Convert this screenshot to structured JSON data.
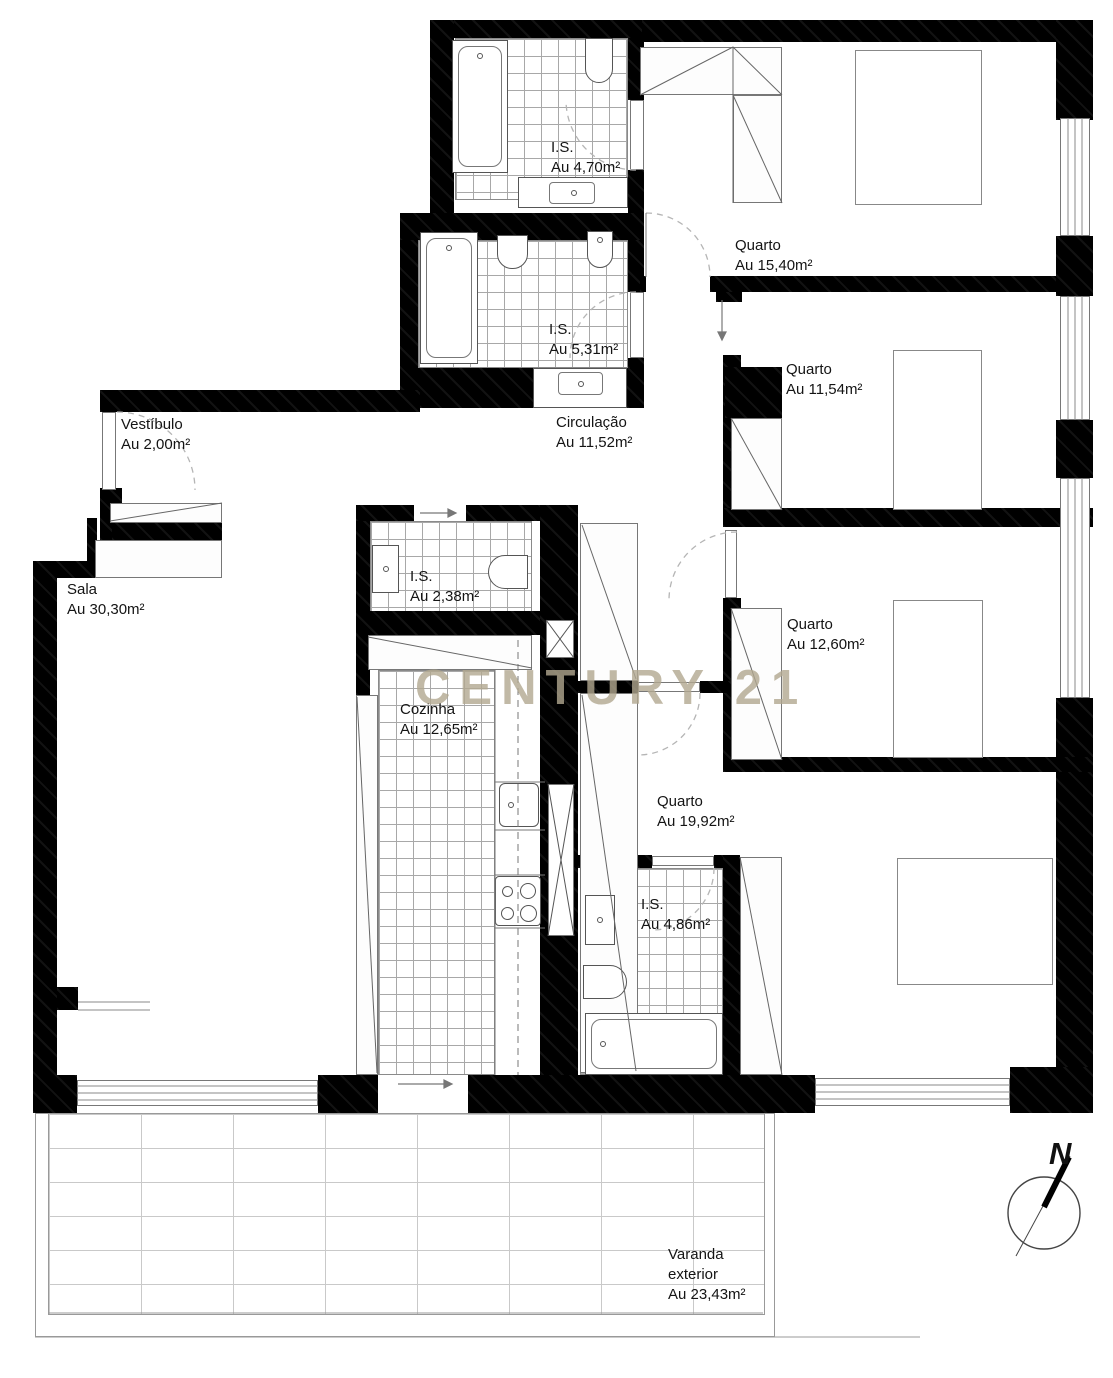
{
  "plan": {
    "watermark": "CENTURY 21",
    "compass": {
      "north_label": "N"
    },
    "rooms": [
      {
        "name": "I.S.",
        "area": "Au 4,70m²"
      },
      {
        "name": "Quarto",
        "area": "Au 15,40m²"
      },
      {
        "name": "I.S.",
        "area": "Au 5,31m²"
      },
      {
        "name": "Circulação",
        "area": "Au 11,52m²"
      },
      {
        "name": "Vestíbulo",
        "area": "Au 2,00m²"
      },
      {
        "name": "Quarto",
        "area": "Au 11,54m²"
      },
      {
        "name": "Sala",
        "area": "Au 30,30m²"
      },
      {
        "name": "I.S.",
        "area": "Au 2,38m²"
      },
      {
        "name": "Quarto",
        "area": "Au 12,60m²"
      },
      {
        "name": "Cozinha",
        "area": "Au 12,65m²"
      },
      {
        "name": "Quarto",
        "area": "Au 19,92m²"
      },
      {
        "name": "I.S.",
        "area": "Au 4,86m²"
      },
      {
        "name": "Varanda",
        "name2": "exterior",
        "area": "Au 23,43m²"
      }
    ]
  }
}
